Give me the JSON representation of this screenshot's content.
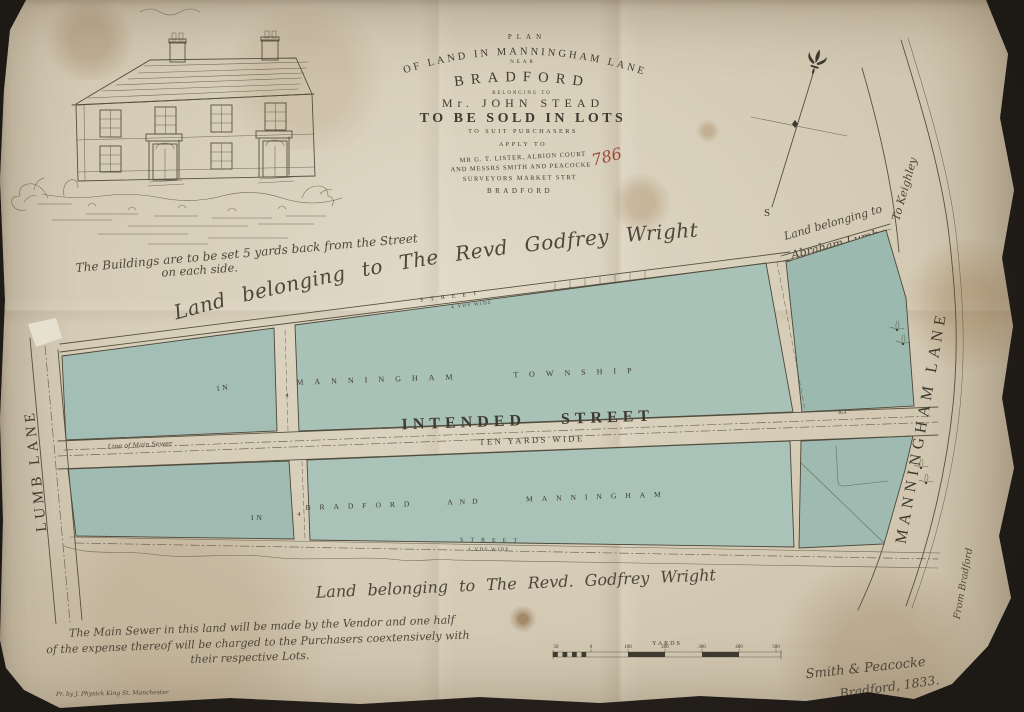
{
  "palette": {
    "backdrop": "#29241e",
    "paper": "#d4cbb6",
    "ink": "#3e3a2f",
    "ink-light": "#55503f",
    "script-ink": "#4e4739",
    "parcel-green": "#a6c0b6",
    "red-annotation": "#9a4a38"
  },
  "title_block": {
    "plan": "PLAN",
    "arc_line": "OF LAND IN MANNINGHAM LANE",
    "near": "NEAR",
    "town": "BRADFORD",
    "belonging_to": "BELONGING TO",
    "owner": "Mr. JOHN STEAD",
    "sale_line": "TO BE SOLD IN LOTS",
    "suit_line": "TO SUIT PURCHASERS",
    "apply_line": "APPLY TO",
    "agent_line1": "MR G. T. LISTER, ALBION COURT",
    "agent_line2": "AND MESSRS SMITH AND PEACOCKE",
    "agent_line3": "SURVEYORS MARKET STRT",
    "agent_line4": "BRADFORD",
    "handwritten_number": "786"
  },
  "vignette": {
    "caption_line1": "The Buildings are to be set 5 yards back from the Street",
    "caption_line2": "on each side."
  },
  "compass": {
    "south": "S"
  },
  "owners": {
    "north": "Land belonging to The Revd Godfrey Wright",
    "south": "Land belonging to The Revd. Godfrey Wright",
    "east_line1": "Land belonging to",
    "east_line2": "Abraham Lumb"
  },
  "directions": {
    "to_keighley": "To Keighley",
    "from_bradford": "From Bradford"
  },
  "lanes": {
    "west": "LUMB LANE",
    "east": "MANNINGHAM LANE"
  },
  "streets": {
    "intended_name": "INTENDED STREET",
    "intended_width": "TEN YARDS WIDE",
    "north_name": "STREET",
    "north_width": "4 YDS WIDE",
    "south_name": "STREET",
    "south_width": "4 YDS WIDE",
    "sewer_label": "Line of Main Sewer",
    "cross_mark_upper": "4",
    "cross_mark_lower": "4",
    "measure_mark": "36.4"
  },
  "parcels": {
    "upper_left": "IN",
    "upper_word1": "MANNINGHAM",
    "upper_word2": "TOWNSHIP",
    "lower_left": "IN",
    "lower_word1": "BRADFORD",
    "lower_word2": "AND",
    "lower_word3": "MANNINGHAM"
  },
  "note": {
    "line1": "The Main Sewer in this land will be made by the Vendor and one half",
    "line2": "of the expense thereof will be charged to the Purchasers coextensively with",
    "line3": "their respective Lots."
  },
  "scale_bar": {
    "unit_label": "YARDS",
    "ticks": [
      "50",
      "0",
      "100",
      "200",
      "300",
      "400",
      "500"
    ]
  },
  "signature": {
    "line1": "Smith & Peacocke",
    "line2": "Bradford, 1833."
  },
  "imprint": "Pr. by J. Physick King St. Manchester"
}
